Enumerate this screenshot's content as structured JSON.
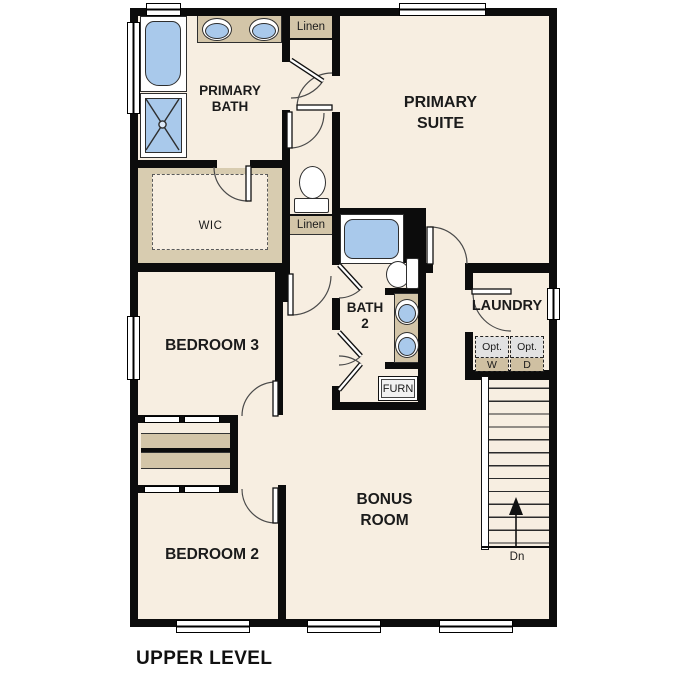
{
  "plan_title": "UPPER LEVEL",
  "rooms": {
    "primary_bath": {
      "line1": "PRIMARY",
      "line2": "BATH"
    },
    "primary_suite": {
      "line1": "PRIMARY",
      "line2": "SUITE"
    },
    "wic": {
      "label": "WIC"
    },
    "bedroom3": {
      "label": "BEDROOM 3"
    },
    "bath2": {
      "line1": "BATH",
      "line2": "2"
    },
    "laundry": {
      "label": "LAUNDRY"
    },
    "bedroom2": {
      "label": "BEDROOM 2"
    },
    "bonus_room": {
      "line1": "BONUS",
      "line2": "ROOM"
    }
  },
  "closets": {
    "linen_upper": {
      "label": "Linen"
    },
    "linen_lower": {
      "label": "Linen"
    },
    "furnace": {
      "label": "FURN"
    }
  },
  "appliances": {
    "washer": {
      "line1": "Opt.",
      "line2": "W"
    },
    "dryer": {
      "line1": "Opt.",
      "line2": "D"
    }
  },
  "stairs": {
    "label": "Dn"
  },
  "colors": {
    "floor": "#f7eee1",
    "wall": "#0c0c0c",
    "casework": "#d3c5a8",
    "fixture_blue": "#a9c9eb",
    "appliance_gray": "#e2e2e2"
  }
}
